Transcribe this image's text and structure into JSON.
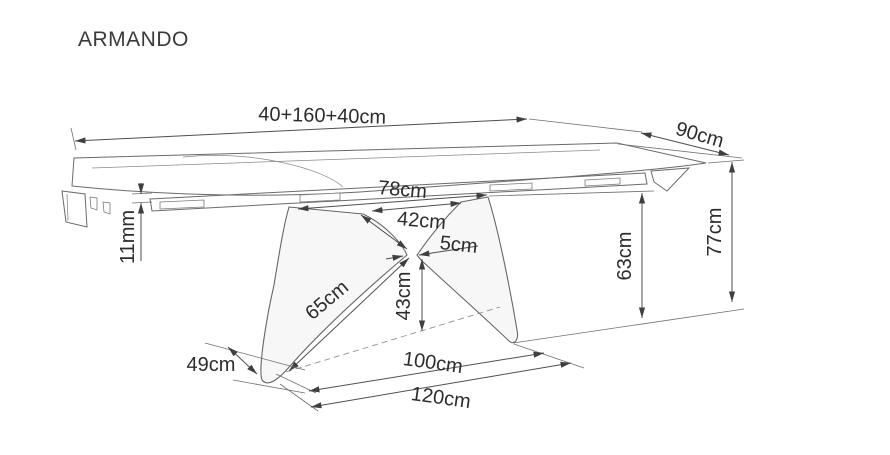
{
  "title": "ARMANDO",
  "drawing": {
    "type": "furniture technical drawing, extendable dining table",
    "dims": {
      "top_length": "40+160+40cm",
      "top_depth": "90cm",
      "total_height": "77cm",
      "apron_height": "63cm",
      "base_top_length": "78cm",
      "legs_top_gap": "42cm",
      "waist_thickness": "5cm",
      "rail_gap": "11mm",
      "leg_slant_length": "65cm",
      "waist_height": "43cm",
      "foot_width": "49cm",
      "feet_span": "100cm",
      "base_length": "120cm"
    },
    "colors": {
      "background": "#ffffff",
      "line": "#5a5a5a",
      "text": "#2d2d2d",
      "leg_fill": "#f7f7f7"
    }
  }
}
